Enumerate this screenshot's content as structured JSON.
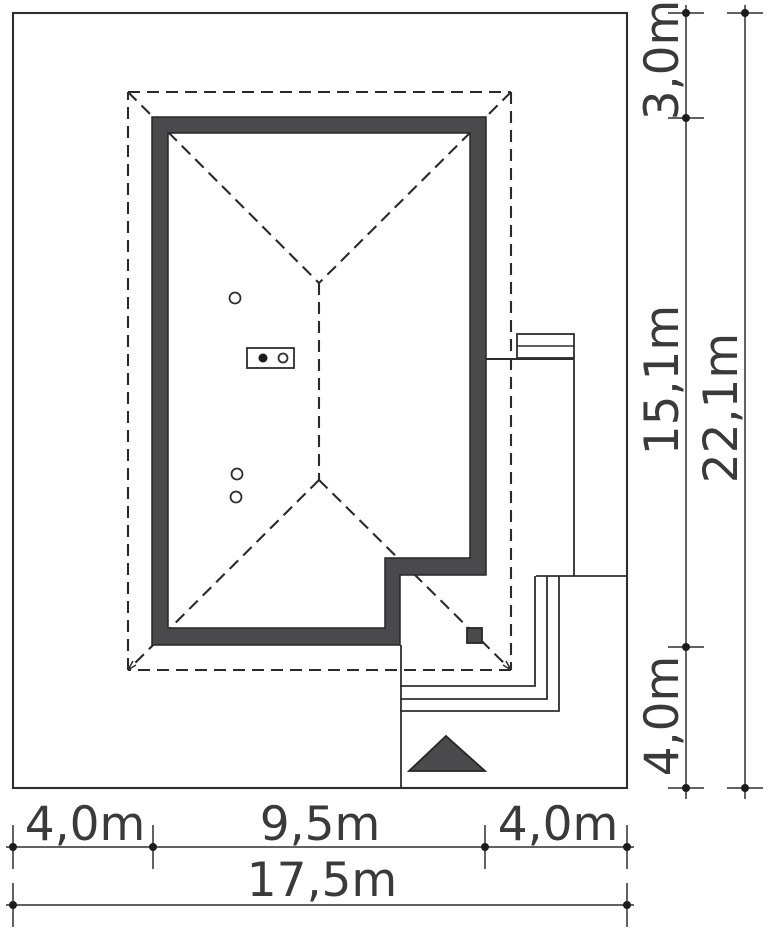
{
  "document": {
    "type": "architectural-site-plan",
    "units": "m"
  },
  "colors": {
    "background": "#ffffff",
    "line": "#2e2e2e",
    "wall_fill": "#4a4a4d",
    "text": "#3a3a3a"
  },
  "dimensions": {
    "right": [
      {
        "id": "front-setback",
        "label": "3,0m",
        "value_m": 3.0
      },
      {
        "id": "house-depth",
        "label": "15,1m",
        "value_m": 15.1
      },
      {
        "id": "rear-setback",
        "label": "4,0m",
        "value_m": 4.0
      },
      {
        "id": "plot-depth",
        "label": "22,1m",
        "value_m": 22.1
      }
    ],
    "bottom": [
      {
        "id": "left-setback",
        "label": "4,0m",
        "value_m": 4.0
      },
      {
        "id": "house-width",
        "label": "9,5m",
        "value_m": 9.5
      },
      {
        "id": "right-setback",
        "label": "4,0m",
        "value_m": 4.0
      },
      {
        "id": "plot-width",
        "label": "17,5m",
        "value_m": 17.5
      }
    ]
  }
}
